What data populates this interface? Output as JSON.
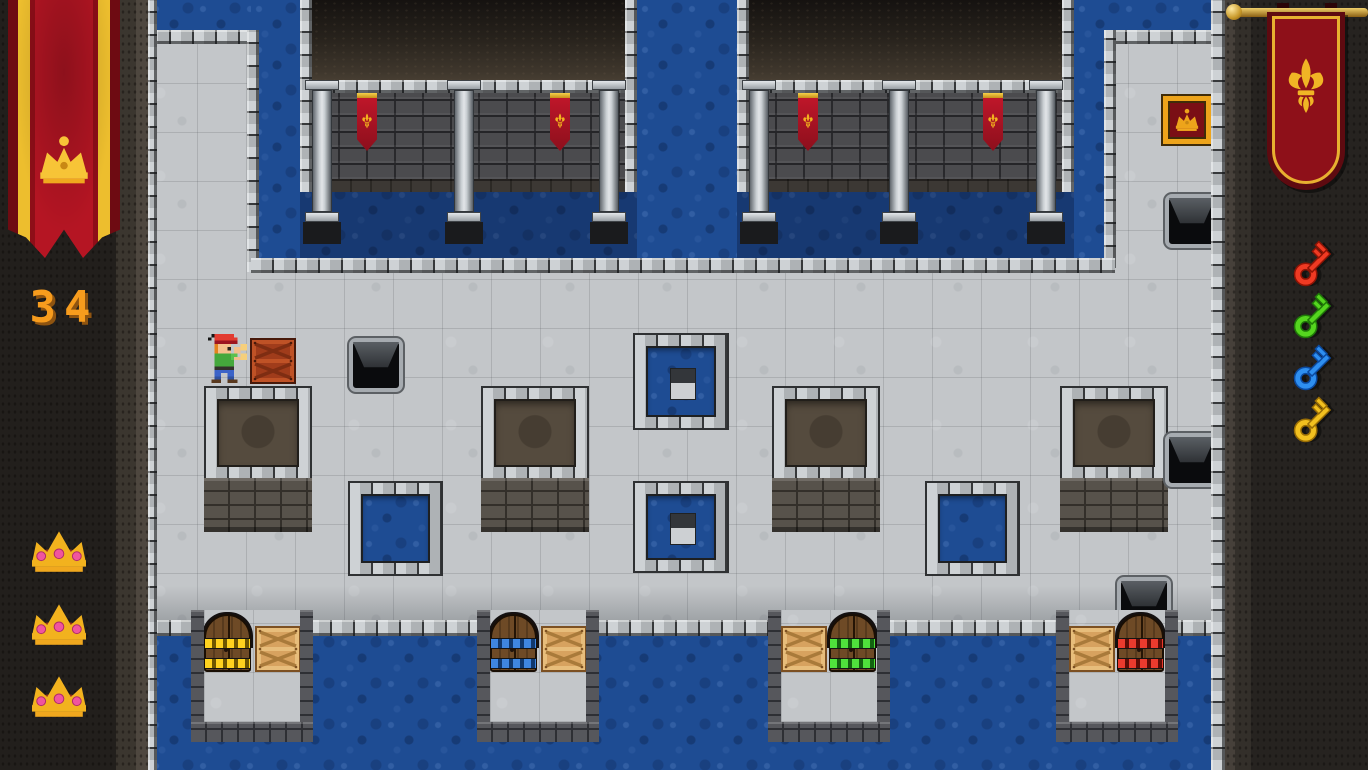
{
  "hud": {
    "score": "34",
    "lives": 3,
    "left_banner_emblem": "crown",
    "right_banner_emblem": "fleur-de-lis",
    "keys": [
      {
        "name": "red-key",
        "color": "#ef3a23",
        "dark": "#8f1405"
      },
      {
        "name": "green-key",
        "color": "#55d51f",
        "dark": "#1f7a08"
      },
      {
        "name": "blue-key",
        "color": "#2e8ff0",
        "dark": "#0b4aa0"
      },
      {
        "name": "yellow-key",
        "color": "#f2c01f",
        "dark": "#9a6e05"
      }
    ],
    "colors": {
      "score": "#f79c1d",
      "score_shadow": "#8f5410",
      "gold": "#f2b21e",
      "banner_red": "#b51523",
      "gem_pink": "#f0559e"
    }
  },
  "scene": {
    "width": 1368,
    "height": 770,
    "tile_size": 48,
    "game_area": {
      "x": 148,
      "w": 1077
    },
    "door_colors": {
      "yellow": {
        "band": "#ffd21f",
        "dash": "#6e5600"
      },
      "blue": {
        "band": "#3f86e0",
        "dash": "#10386e"
      },
      "green": {
        "band": "#4fe23c",
        "dash": "#136310"
      },
      "red": {
        "band": "#ea3b2e",
        "dash": "#5e0c06"
      }
    },
    "crate_colors": {
      "tan": {
        "base": "#d7a25f",
        "rail": "#e7bd7b",
        "dark": "#7c5022",
        "line": "#a97a3a"
      },
      "red": {
        "base": "#a03c1b",
        "rail": "#bf5226",
        "dark": "#47190a",
        "line": "#7e2d12"
      }
    },
    "elements": [
      {
        "type": "floor",
        "x": 148,
        "y": 0,
        "w": 1077,
        "h": 770,
        "name": "stone-floor"
      },
      {
        "type": "floorShade",
        "x": 148,
        "y": 586,
        "w": 1077,
        "h": 36,
        "name": "floor-shadow-edge"
      },
      {
        "type": "water",
        "x": 148,
        "y": 0,
        "w": 107,
        "h": 36,
        "name": "moat-top-left"
      },
      {
        "type": "water",
        "x": 251,
        "y": 0,
        "w": 49,
        "h": 272,
        "name": "moat-left-column"
      },
      {
        "type": "water",
        "x": 637,
        "y": 0,
        "w": 100,
        "h": 272,
        "name": "moat-center-channel"
      },
      {
        "type": "water",
        "x": 1074,
        "y": 0,
        "w": 41,
        "h": 268,
        "name": "moat-right-channel"
      },
      {
        "type": "water",
        "x": 1074,
        "y": 0,
        "w": 137,
        "h": 36,
        "name": "moat-top-right"
      },
      {
        "type": "water",
        "x": 300,
        "y": 186,
        "w": 337,
        "h": 86,
        "dark": true,
        "name": "moat-below-left-hall"
      },
      {
        "type": "water",
        "x": 737,
        "y": 186,
        "w": 337,
        "h": 86,
        "dark": true,
        "name": "moat-below-right-hall"
      },
      {
        "type": "water",
        "x": 148,
        "y": 634,
        "w": 1077,
        "h": 136,
        "name": "moat-bottom"
      },
      {
        "type": "ledgeH",
        "x": 148,
        "y": 30,
        "w": 111,
        "h": 14,
        "name": "ledge"
      },
      {
        "type": "ledgeV",
        "x": 247,
        "y": 30,
        "w": 12,
        "h": 242,
        "name": "ledge"
      },
      {
        "type": "ledgeH",
        "x": 1104,
        "y": 30,
        "w": 107,
        "h": 14,
        "name": "ledge"
      },
      {
        "type": "ledgeV",
        "x": 1104,
        "y": 30,
        "w": 12,
        "h": 238,
        "name": "ledge"
      },
      {
        "type": "ledgeH",
        "x": 251,
        "y": 258,
        "w": 864,
        "h": 15,
        "name": "ledge"
      },
      {
        "type": "ledgeH",
        "x": 148,
        "y": 620,
        "w": 1077,
        "h": 16,
        "name": "ledge"
      },
      {
        "type": "castleRoom",
        "x": 300,
        "y": 0,
        "w": 337,
        "pillars": [
          8,
          150,
          295
        ],
        "banners": [
          57,
          250
        ],
        "name": "castle-hall-left"
      },
      {
        "type": "castleRoom",
        "x": 737,
        "y": 0,
        "w": 337,
        "pillars": [
          8,
          148,
          295
        ],
        "banners": [
          61,
          246
        ],
        "name": "castle-hall-right"
      },
      {
        "type": "pit",
        "x": 204,
        "y": 386,
        "w": 108,
        "h": 94,
        "name": "pit-1"
      },
      {
        "type": "pit",
        "x": 481,
        "y": 386,
        "w": 108,
        "h": 94,
        "name": "pit-2"
      },
      {
        "type": "pit",
        "x": 772,
        "y": 386,
        "w": 108,
        "h": 94,
        "name": "pit-3"
      },
      {
        "type": "pit",
        "x": 1060,
        "y": 386,
        "w": 108,
        "h": 94,
        "name": "pit-4"
      },
      {
        "type": "pool",
        "x": 348,
        "y": 481,
        "w": 95,
        "h": 95,
        "name": "pool-small-1"
      },
      {
        "type": "pool",
        "x": 925,
        "y": 481,
        "w": 95,
        "h": 95,
        "name": "pool-small-2"
      },
      {
        "type": "islandPool",
        "x": 633,
        "y": 333,
        "w": 96,
        "h": 97,
        "name": "island-pool-upper"
      },
      {
        "type": "islandPool",
        "x": 633,
        "y": 481,
        "w": 96,
        "h": 92,
        "name": "island-pool-lower"
      },
      {
        "type": "holeTile",
        "x": 349,
        "y": 338,
        "w": 46,
        "h": 46,
        "name": "hole-tile-1"
      },
      {
        "type": "holeTile",
        "x": 1165,
        "y": 194,
        "w": 46,
        "h": 46,
        "name": "hole-tile-2"
      },
      {
        "type": "holeTile",
        "x": 1165,
        "y": 433,
        "w": 46,
        "h": 46,
        "name": "hole-tile-3"
      },
      {
        "type": "holeTile",
        "x": 1117,
        "y": 577,
        "w": 46,
        "h": 46,
        "name": "hole-tile-4"
      },
      {
        "type": "goalTile",
        "x": 1163,
        "y": 96,
        "w": 48,
        "h": 48,
        "name": "goal-crown-tile"
      },
      {
        "type": "dockRoom",
        "x": 191,
        "y": 610,
        "door": {
          "rel": 13,
          "color": "yellow"
        },
        "crate": {
          "rel": 64
        },
        "name": "dock-room-yellow"
      },
      {
        "type": "dockRoom",
        "x": 477,
        "y": 610,
        "door": {
          "rel": 13,
          "color": "blue"
        },
        "crate": {
          "rel": 64
        },
        "name": "dock-room-blue"
      },
      {
        "type": "dockRoom",
        "x": 768,
        "y": 610,
        "door": {
          "rel": 61,
          "color": "green"
        },
        "crate": {
          "rel": 13
        },
        "name": "dock-room-green"
      },
      {
        "type": "dockRoom",
        "x": 1056,
        "y": 610,
        "door": {
          "rel": 61,
          "color": "red"
        },
        "crate": {
          "rel": 13
        },
        "name": "dock-room-red"
      },
      {
        "type": "crate",
        "x": 250,
        "y": 338,
        "w": 46,
        "h": 46,
        "variant": "red",
        "name": "pushed-crate"
      },
      {
        "type": "player",
        "x": 204,
        "y": 334,
        "w": 44,
        "h": 52,
        "name": "player-character"
      },
      {
        "type": "ledgeV",
        "x": 148,
        "y": 0,
        "w": 9,
        "h": 770,
        "name": "left-edge-ledge"
      },
      {
        "type": "ledgeV",
        "x": 1211,
        "y": 0,
        "w": 14,
        "h": 770,
        "name": "right-edge-ledge"
      }
    ]
  }
}
